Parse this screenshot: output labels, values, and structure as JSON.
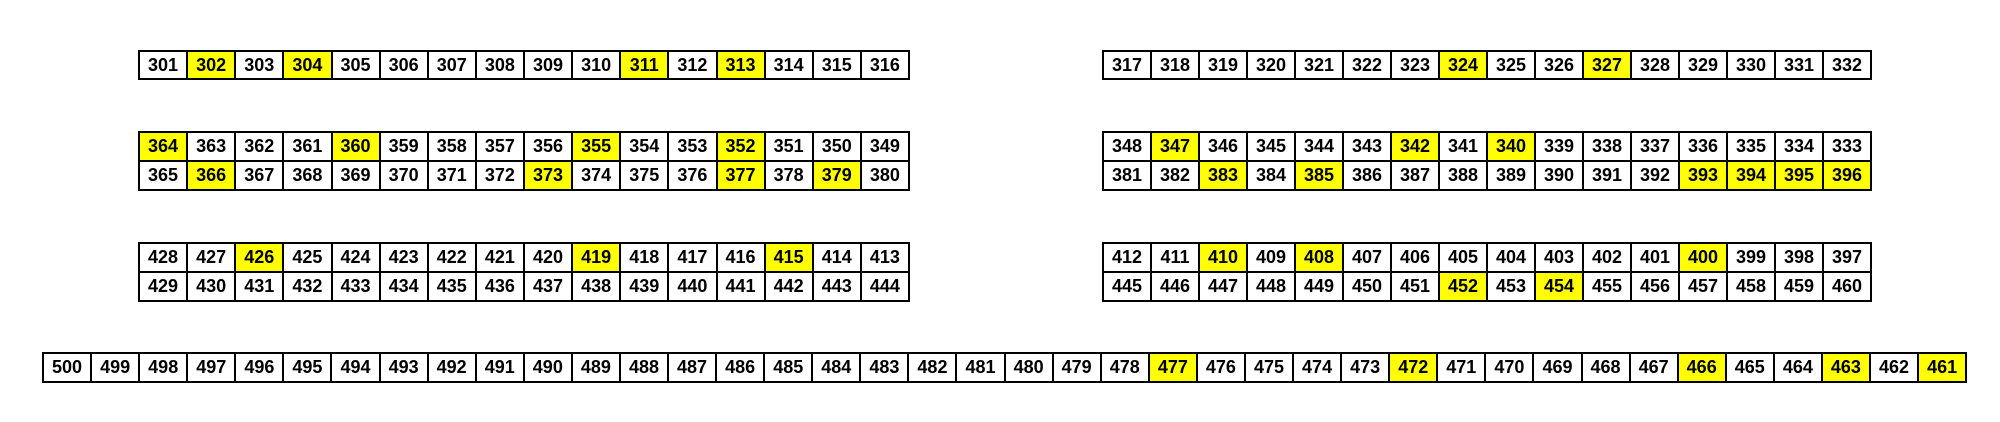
{
  "page": {
    "width": 2000,
    "height": 422,
    "background": "#ffffff"
  },
  "style": {
    "highlight_color": "#ffff00",
    "cell_background": "#ffffff",
    "border_color": "#000000",
    "text_color": "#000000"
  },
  "number_chart": {
    "highlighted_numbers": [
      302,
      304,
      311,
      313,
      324,
      327,
      340,
      342,
      347,
      352,
      355,
      360,
      364,
      366,
      373,
      377,
      379,
      383,
      385,
      393,
      394,
      395,
      396,
      400,
      408,
      410,
      415,
      419,
      426,
      452,
      454,
      461,
      463,
      466,
      472,
      477
    ],
    "blocks": [
      {
        "name": "top-band-left",
        "x": 138,
        "y": 50,
        "width": 772,
        "cell_h": 26,
        "rows": [
          [
            301,
            302,
            303,
            304,
            305,
            306,
            307,
            308,
            309,
            310,
            311,
            312,
            313,
            314,
            315,
            316
          ]
        ]
      },
      {
        "name": "top-band-right",
        "x": 1102,
        "y": 50,
        "width": 770,
        "cell_h": 26,
        "rows": [
          [
            317,
            318,
            319,
            320,
            321,
            322,
            323,
            324,
            325,
            326,
            327,
            328,
            329,
            330,
            331,
            332
          ]
        ]
      },
      {
        "name": "second-band-left",
        "x": 138,
        "y": 131,
        "width": 772,
        "cell_h": 27,
        "rows": [
          [
            364,
            363,
            362,
            361,
            360,
            359,
            358,
            357,
            356,
            355,
            354,
            353,
            352,
            351,
            350,
            349
          ],
          [
            365,
            366,
            367,
            368,
            369,
            370,
            371,
            372,
            373,
            374,
            375,
            376,
            377,
            378,
            379,
            380
          ]
        ]
      },
      {
        "name": "second-band-right",
        "x": 1102,
        "y": 131,
        "width": 770,
        "cell_h": 27,
        "rows": [
          [
            348,
            347,
            346,
            345,
            344,
            343,
            342,
            341,
            340,
            339,
            338,
            337,
            336,
            335,
            334,
            333
          ],
          [
            381,
            382,
            383,
            384,
            385,
            386,
            387,
            388,
            389,
            390,
            391,
            392,
            393,
            394,
            395,
            396
          ]
        ]
      },
      {
        "name": "third-band-left",
        "x": 138,
        "y": 242,
        "width": 772,
        "cell_h": 27,
        "rows": [
          [
            428,
            427,
            426,
            425,
            424,
            423,
            422,
            421,
            420,
            419,
            418,
            417,
            416,
            415,
            414,
            413
          ],
          [
            429,
            430,
            431,
            432,
            433,
            434,
            435,
            436,
            437,
            438,
            439,
            440,
            441,
            442,
            443,
            444
          ]
        ]
      },
      {
        "name": "third-band-right",
        "x": 1102,
        "y": 242,
        "width": 770,
        "cell_h": 27,
        "rows": [
          [
            412,
            411,
            410,
            409,
            408,
            407,
            406,
            405,
            404,
            403,
            402,
            401,
            400,
            399,
            398,
            397
          ],
          [
            445,
            446,
            447,
            448,
            449,
            450,
            451,
            452,
            453,
            454,
            455,
            456,
            457,
            458,
            459,
            460
          ]
        ]
      },
      {
        "name": "bottom-band",
        "x": 42,
        "y": 352,
        "width": 1925,
        "cell_h": 27,
        "rows": [
          [
            500,
            499,
            498,
            497,
            496,
            495,
            494,
            493,
            492,
            491,
            490,
            489,
            488,
            487,
            486,
            485,
            484,
            483,
            482,
            481,
            480,
            479,
            478,
            477,
            476,
            475,
            474,
            473,
            472,
            471,
            470,
            469,
            468,
            467,
            466,
            465,
            464,
            463,
            462,
            461
          ]
        ]
      }
    ]
  }
}
